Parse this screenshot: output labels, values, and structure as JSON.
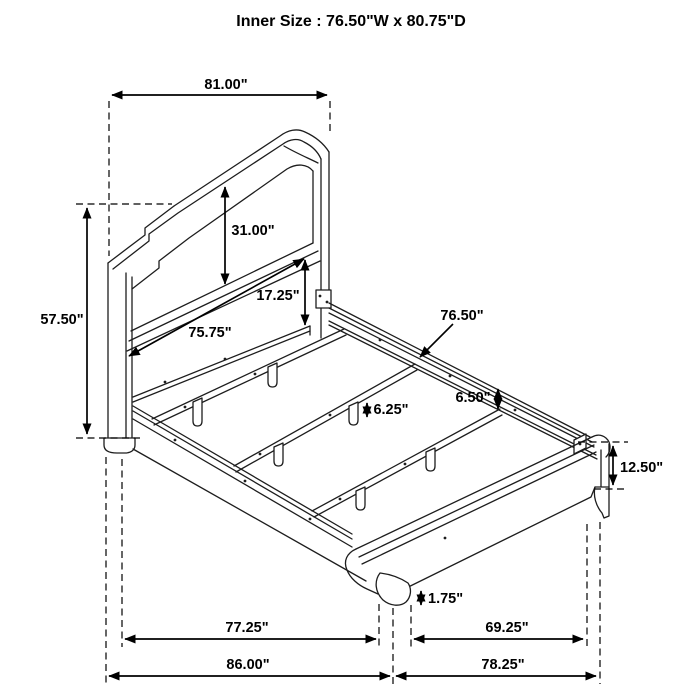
{
  "title": "Inner Size : 76.50\"W x 80.75\"D",
  "dimensions": {
    "headboard_width": "81.00\"",
    "headboard_height": "57.50\"",
    "headboard_panel_height": "31.00\"",
    "panel_bottom_to_rail": "17.25\"",
    "rail_length": "75.75\"",
    "inner_width": "76.50\"",
    "side_rail_height": "6.50\"",
    "slat_leg_height": "6.25\"",
    "footboard_height": "12.50\"",
    "foot_height": "1.75\"",
    "inner_depth": "77.25\"",
    "overall_depth": "86.00\"",
    "footboard_inner_width": "69.25\"",
    "footboard_outer_width": "78.25\""
  },
  "line_color": "#1d1d1d",
  "background_color": "#ffffff"
}
